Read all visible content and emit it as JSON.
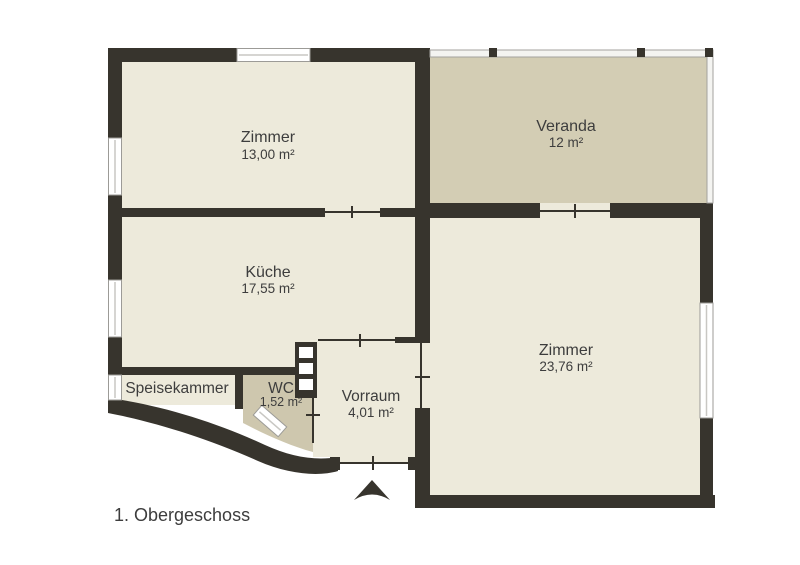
{
  "floor_label": "1. Obergeschoss",
  "rooms": {
    "zimmer1": {
      "name": "Zimmer",
      "area": "13,00 m²"
    },
    "veranda": {
      "name": "Veranda",
      "area": "12 m²"
    },
    "kueche": {
      "name": "Küche",
      "area": "17,55 m²"
    },
    "zimmer2": {
      "name": "Zimmer",
      "area": "23,76 m²"
    },
    "speisekammer": {
      "name": "Speisekammer"
    },
    "wc": {
      "name": "WC",
      "area": "1,52 m²"
    },
    "vorraum": {
      "name": "Vorraum",
      "area": "4,01 m²"
    }
  },
  "icons": {
    "entrance_arrow": "north-entrance-arrow"
  },
  "colors": {
    "wall": "#37342d",
    "room_fill": "#edeadb",
    "veranda_fill": "#d3cdb4",
    "wc_fill": "#cec7ae",
    "window_frame": "#9c9b97",
    "window_center": "#c8c7c3",
    "glass_frame": "#a3a29e",
    "text": "#3d3d3d"
  }
}
